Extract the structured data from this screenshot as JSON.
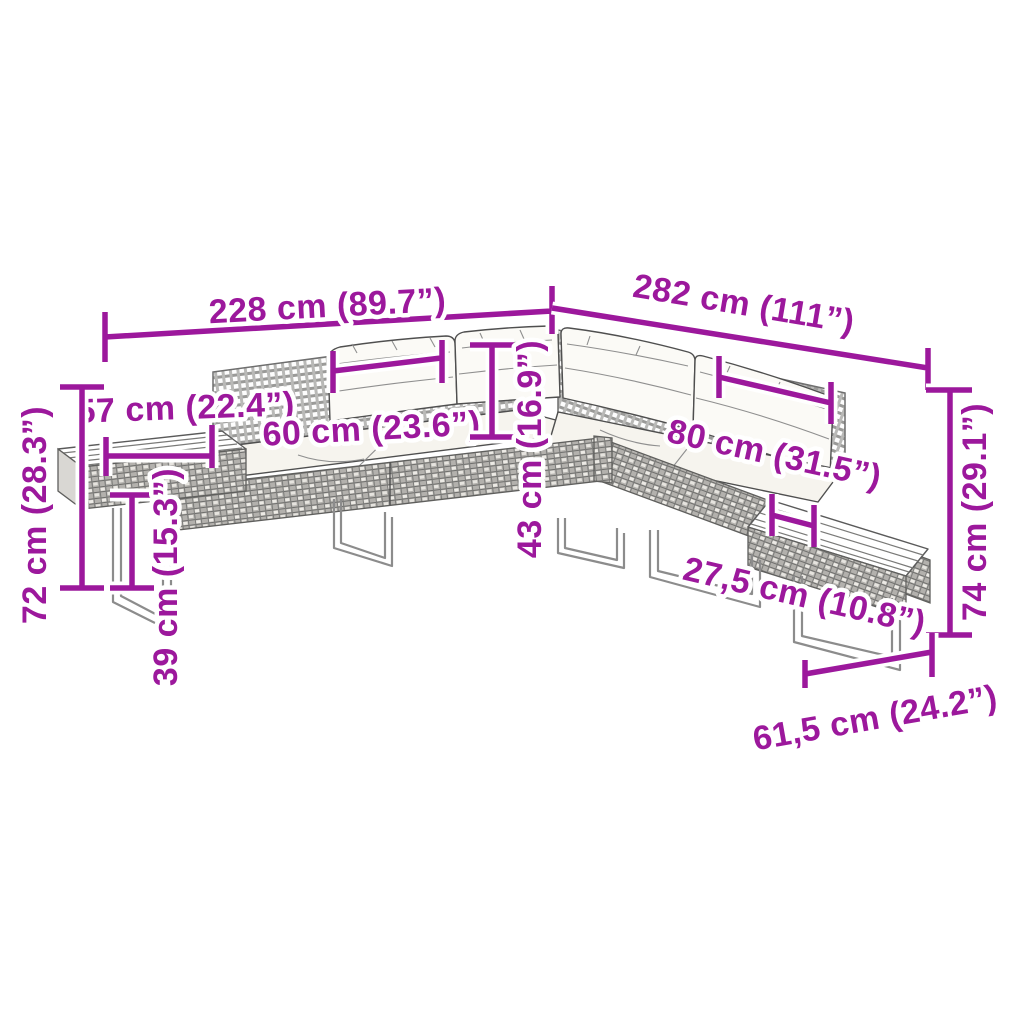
{
  "diagram": {
    "type": "product-dimension-drawing",
    "subject": "L-shaped poly rattan garden corner sofa set with back and seat cushions, sled legs and slatted side tables, sketch style with magenta dimension lines",
    "background_color": "#ffffff",
    "accent_color": "#9C189C",
    "ink_color": "#4f4f4f",
    "dimensions": [
      {
        "id": "total-width-left",
        "label": "228 cm (89.7”)"
      },
      {
        "id": "total-width-right",
        "label": "282 cm (111”)"
      },
      {
        "id": "arm-depth-left",
        "label": "57 cm (22.4”)"
      },
      {
        "id": "seat-width-left",
        "label": "60 cm (23.6”)"
      },
      {
        "id": "overall-height-left",
        "label": "72 cm (28.3”)"
      },
      {
        "id": "side-table-height",
        "label": "39 cm (15.3”)"
      },
      {
        "id": "backrest-height",
        "label": "43 cm (16.9”)"
      },
      {
        "id": "seat-width-right",
        "label": "80 cm (31.5”)"
      },
      {
        "id": "side-table-width",
        "label": "27,5 cm (10.8”)"
      },
      {
        "id": "overall-height-right",
        "label": "74 cm (29.1”)"
      },
      {
        "id": "side-table-depth",
        "label": "61,5 cm (24.2”)"
      }
    ]
  }
}
